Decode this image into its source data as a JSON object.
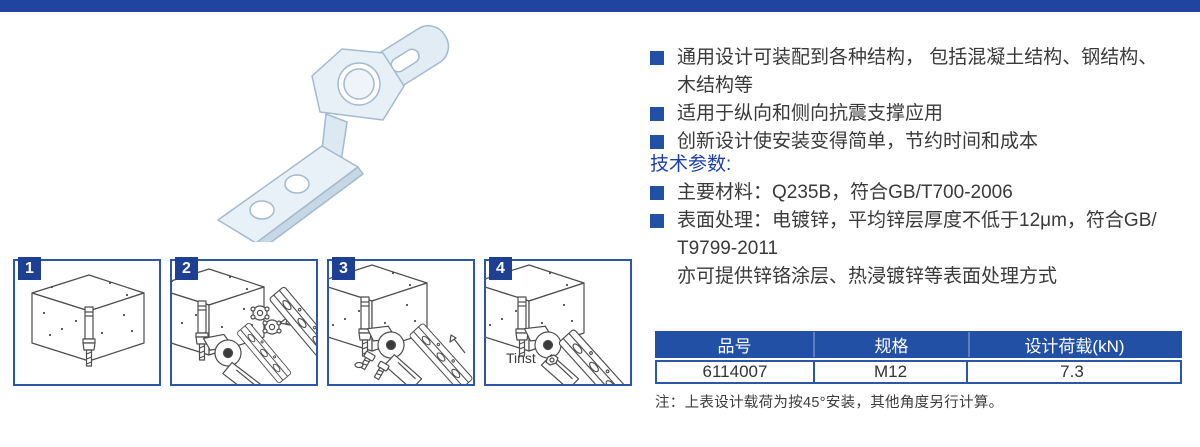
{
  "colors": {
    "accent_bar": "#21459e",
    "bullet_square": "#2150a5",
    "panel_border": "#2b57a8",
    "badge_bg": "#1d3f94",
    "tech_heading_blue": "#1c3fae",
    "table_header_bg": "#2150a5",
    "table_header_text": "#ffffff"
  },
  "features": [
    {
      "lines": [
        "通用设计可装配到各种结构， 包括混凝土结构、钢结构、",
        "木结构等"
      ]
    },
    {
      "lines": [
        "适用于纵向和侧向抗震支撑应用"
      ]
    },
    {
      "lines": [
        "创新设计使安装变得简单，节约时间和成本"
      ]
    }
  ],
  "tech": {
    "heading": "技术参数:",
    "items": [
      {
        "lines": [
          "主要材料：Q235B，符合GB/T700-2006"
        ]
      },
      {
        "lines": [
          "表面处理：电镀锌，平均锌层厚度不低于12μm，符合GB/",
          "T9799-2011",
          "亦可提供锌铬涂层、热浸镀锌等表面处理方式"
        ]
      }
    ]
  },
  "steps": [
    {
      "number": "1"
    },
    {
      "number": "2"
    },
    {
      "number": "3"
    },
    {
      "number": "4",
      "annotation": "Tinst"
    }
  ],
  "table": {
    "headers": [
      "品号",
      "规格",
      "设计荷载(kN)"
    ],
    "rows": [
      {
        "part_no": "6114007",
        "spec": "M12",
        "design_load": "7.3"
      }
    ]
  },
  "note": "注：上表设计载荷为按45°安装，其他角度另行计算。"
}
